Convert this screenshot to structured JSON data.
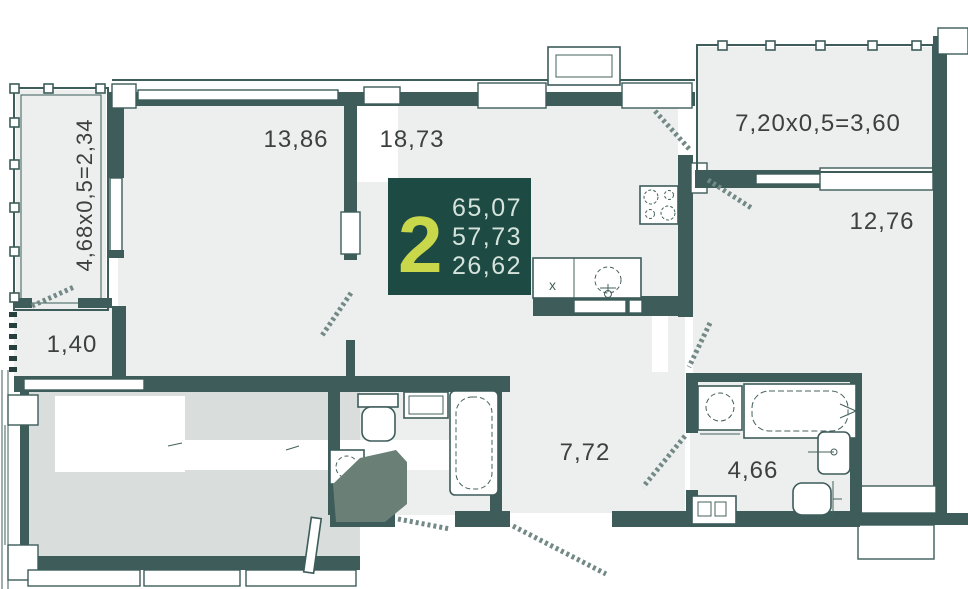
{
  "plan": {
    "type": "apartment-floor-plan",
    "badge": {
      "rooms_count": "2",
      "area_total": "65,07",
      "area_living": "57,73",
      "area_rooms": "26,62"
    },
    "labels": {
      "balcony_left": "4,68x0,5=2,34",
      "balcony_top": "7,20x0,5=3,60",
      "bedroom_top": "13,86",
      "living_room": "18,73",
      "room_right": "12,76",
      "storage": "1,40",
      "hallway": "7,72",
      "bathroom": "4,66",
      "sink_mark": "x"
    },
    "colors": {
      "wall": "#3d5c5a",
      "room_fill": "#ecefee",
      "bedroom_fill": "#d9dddc",
      "badge_background": "#1d4a43",
      "badge_accent": "#c9d84b",
      "badge_text": "#d5e3dd",
      "cover_polygon": "#6a8077",
      "label_text": "#3c4140"
    }
  }
}
